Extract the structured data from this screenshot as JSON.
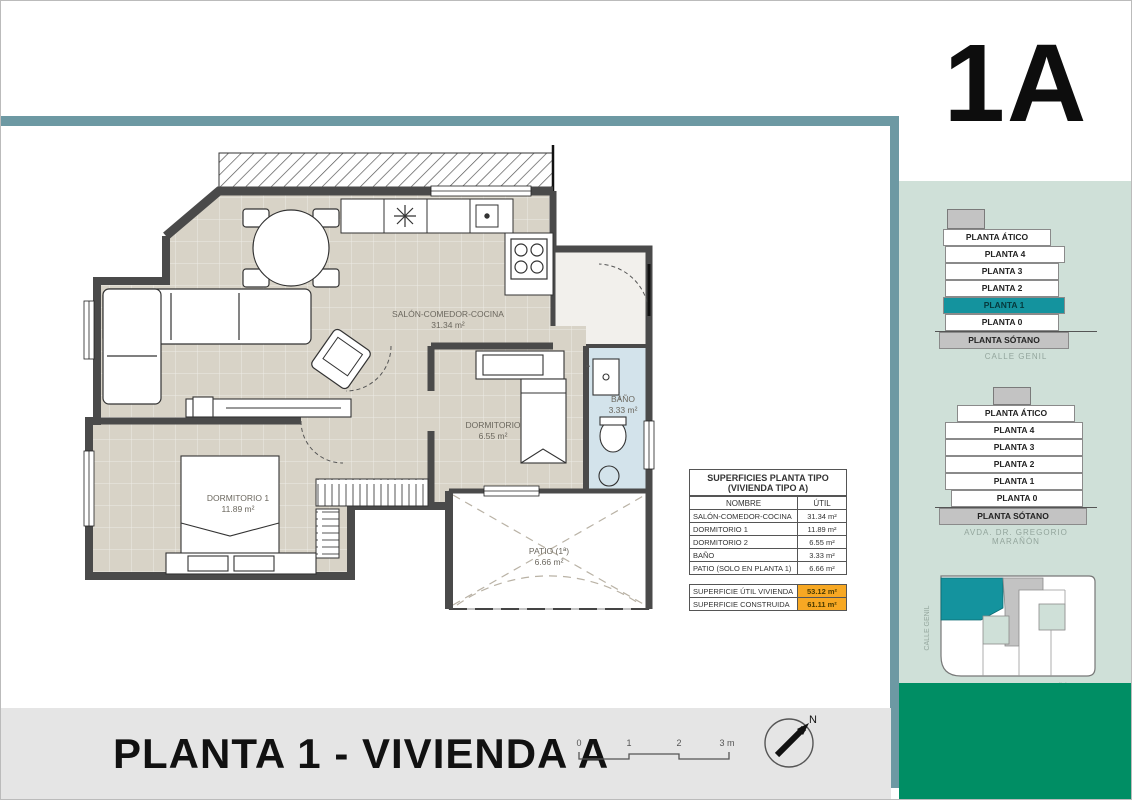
{
  "unit_label": "1A",
  "footer": {
    "title": "PLANTA 1 - VIVIENDA A",
    "scale_ticks": [
      "0",
      "1",
      "2",
      "3 m"
    ],
    "north_label": "N"
  },
  "plan": {
    "rooms": [
      {
        "name": "SALÓN-COMEDOR-COCINA",
        "area": "31.34 m²"
      },
      {
        "name": "DORMITORIO",
        "area": "6.55 m²"
      },
      {
        "name": "BAÑO",
        "area": "3.33 m²"
      },
      {
        "name": "DORMITORIO 1",
        "area": "11.89 m²"
      },
      {
        "name": "PATIO (1ª)",
        "area": "6.66 m²"
      }
    ]
  },
  "table": {
    "title_line1": "SUPERFICIES PLANTA TIPO",
    "title_line2": "(VIVIENDA TIPO A)",
    "col_name": "NOMBRE",
    "col_value": "ÚTIL",
    "rows": [
      {
        "name": "SALÓN-COMEDOR-COCINA",
        "value": "31.34 m²"
      },
      {
        "name": "DORMITORIO 1",
        "value": "11.89 m²"
      },
      {
        "name": "DORMITORIO 2",
        "value": "6.55 m²"
      },
      {
        "name": "BAÑO",
        "value": "3.33 m²"
      },
      {
        "name": "PATIO (SOLO EN PLANTA 1)",
        "value": "6.66 m²"
      }
    ],
    "totals": [
      {
        "name": "SUPERFICIE ÚTIL VIVIENDA",
        "value": "53.12 m²"
      },
      {
        "name": "SUPERFICIE CONSTRUIDA",
        "value": "61.11 m²"
      }
    ]
  },
  "sidebar": {
    "stack1": {
      "floors": [
        "PLANTA ÁTICO",
        "PLANTA 4",
        "PLANTA 3",
        "PLANTA 2",
        "PLANTA 1",
        "PLANTA 0",
        "PLANTA SÓTANO"
      ],
      "highlighted_floor": "PLANTA 1",
      "caption": "CALLE GENIL"
    },
    "stack2": {
      "floors": [
        "PLANTA ÁTICO",
        "PLANTA 4",
        "PLANTA 3",
        "PLANTA 2",
        "PLANTA 1",
        "PLANTA 0",
        "PLANTA SÓTANO"
      ],
      "caption": "AVDA. DR. GREGORIO MARAÑÓN"
    },
    "siteplan": {
      "street_left": "CALLE GENIL",
      "street_bottom": "AVDA. DR GREGORIO MARAÑÓN"
    }
  },
  "colors": {
    "frame_teal": "#6d99a3",
    "highlight_teal": "#14939e",
    "sidebar_bg": "#cfe0d8",
    "dark_green": "#008e64",
    "floor_beige": "#d8d3c7",
    "bath_blue": "#d3e3eb",
    "totals_orange": "#f7a823",
    "footer_gray": "#e5e5e5"
  }
}
